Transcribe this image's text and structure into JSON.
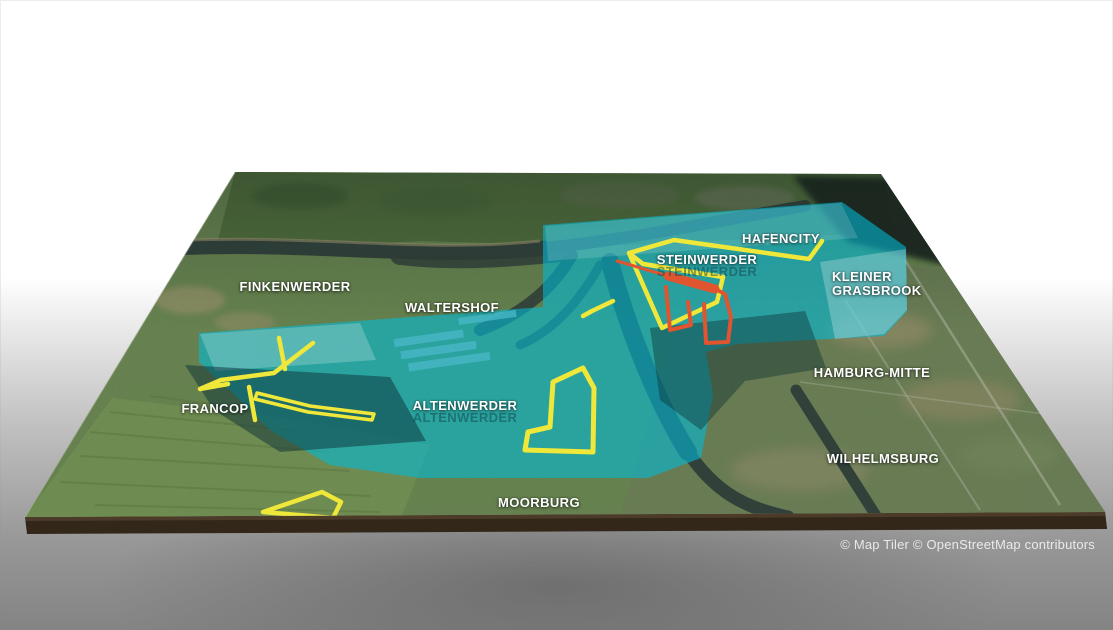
{
  "map": {
    "labels": [
      {
        "id": "finkenwerder",
        "text": "FINKENWERDER",
        "x": 295,
        "y": 287
      },
      {
        "id": "waltershof",
        "text": "WALTERSHOF",
        "x": 452,
        "y": 308
      },
      {
        "id": "steinwerder",
        "text": "STEINWERDER",
        "x": 707,
        "y": 260,
        "ghost": true
      },
      {
        "id": "hafencity",
        "text": "HAFENCITY",
        "x": 781,
        "y": 239
      },
      {
        "id": "kleiner-grasbrook",
        "text": "KLEINER\nGRASBROOK",
        "x": 832,
        "y": 284,
        "align": "left"
      },
      {
        "id": "hamburg-mitte",
        "text": "HAMBURG-MITTE",
        "x": 872,
        "y": 373
      },
      {
        "id": "wilhelmsburg",
        "text": "WILHELMSBURG",
        "x": 883,
        "y": 459
      },
      {
        "id": "altenwerder",
        "text": "ALTENWERDER",
        "x": 465,
        "y": 406,
        "ghost": true
      },
      {
        "id": "francop",
        "text": "FRANCOP",
        "x": 215,
        "y": 409
      },
      {
        "id": "moorburg",
        "text": "MOORBURG",
        "x": 539,
        "y": 503
      }
    ],
    "attribution": {
      "text": "© Map Tiler © OpenStreetMap contributors"
    },
    "colors": {
      "overlay_cyan": "#00bcd9",
      "route_yellow": "#efe73a",
      "highlight_orange": "#e05430",
      "water": "#3c4e46",
      "land_green": "#7b9c5f"
    }
  }
}
